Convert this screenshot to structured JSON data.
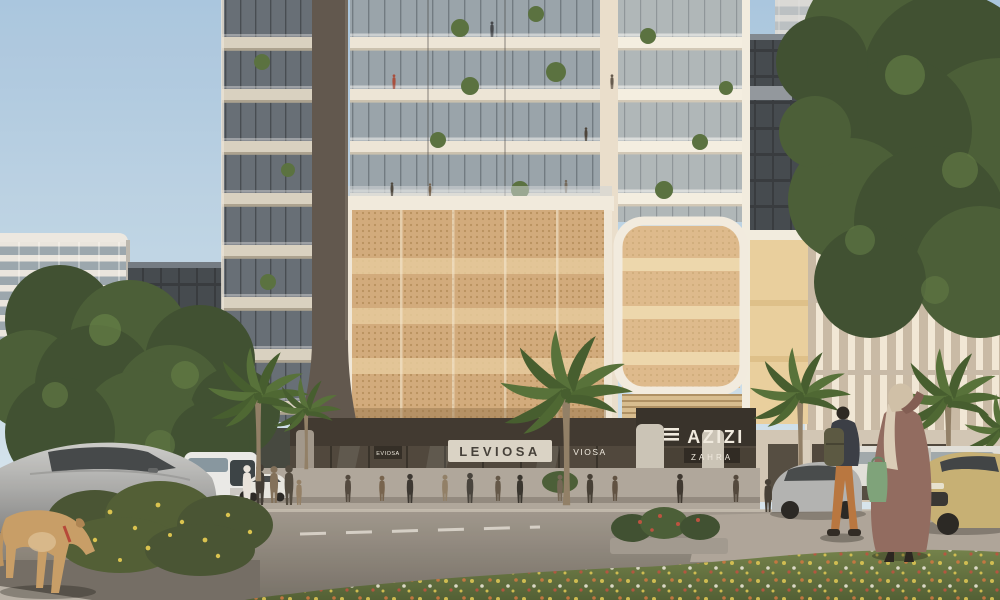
{
  "signs": {
    "brand": "AZIZI",
    "residence": "ZAHRA",
    "store_main": "LEVIOSA",
    "store_side": "VIOSA",
    "store_small": "EVIOSA"
  },
  "colors": {
    "slab": "#ece7db",
    "pillar": "#574f49",
    "fascia": "#342f29",
    "mesh": "#cfa87a",
    "meshLight": "#e4c99c",
    "frameWhite": "#f1ede3",
    "trunk": "#8a7a63",
    "palm": "#4c6b33",
    "grass": "#5c6e3b",
    "road": "#8e8983",
    "sidewalk": "#aaa49b",
    "dog": "#c49a63",
    "abaya": "#8a655c",
    "hijab": "#cdbfa8",
    "bag": "#76a078",
    "signPanel": "#d8d3c9",
    "signTextDark": "#3a3733",
    "signTextLight": "#efece4",
    "bus": "#e9ebec",
    "carSilver": "#aeb1b3",
    "carGold": "#c3ae72",
    "van": "#dfe0dd",
    "tree": "#33482a",
    "treeMid": "#3f5731",
    "treeLight": "#5b7a41"
  }
}
